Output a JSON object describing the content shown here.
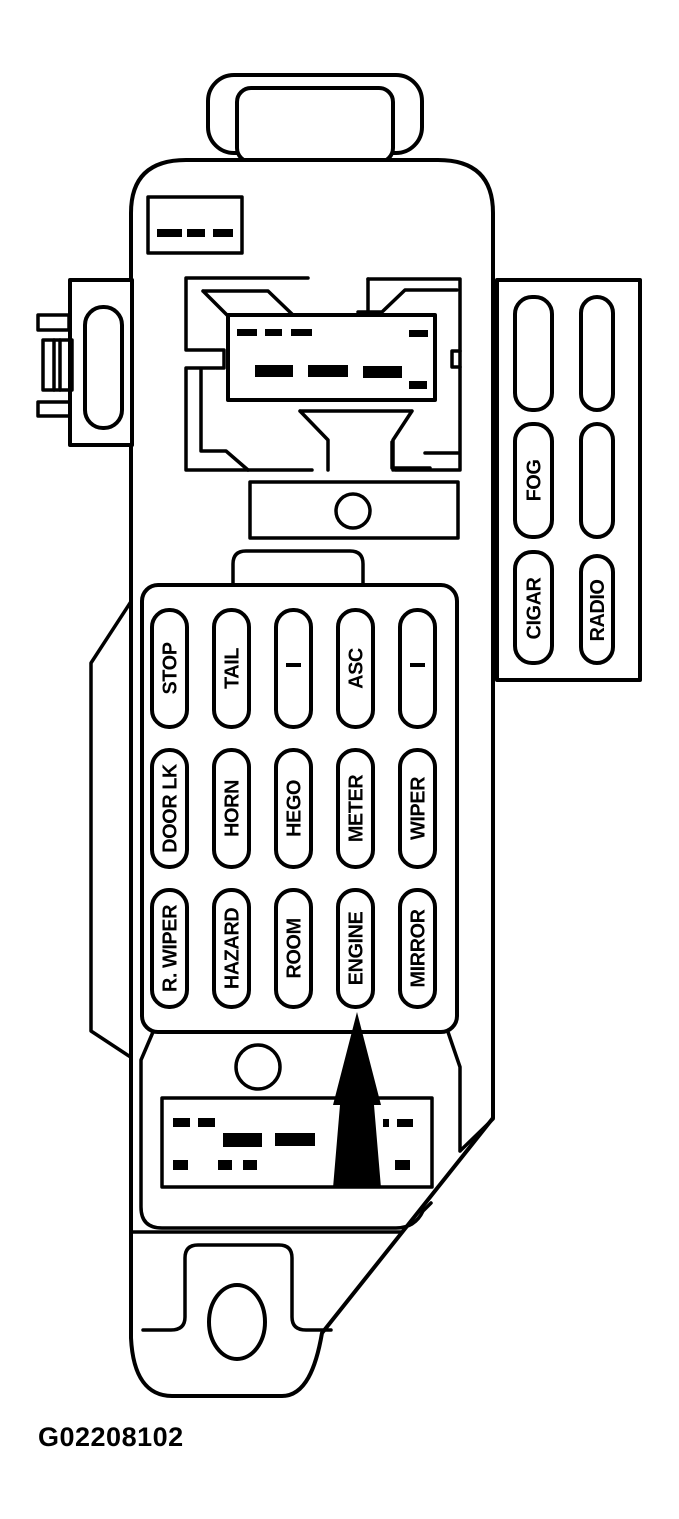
{
  "colors": {
    "ink": "#000000",
    "paper": "#ffffff"
  },
  "caption": "G02208102",
  "fuse_panel": {
    "rows": [
      [
        "STOP",
        "TAIL",
        "–",
        "ASC",
        "–"
      ],
      [
        "DOOR LK",
        "HORN",
        "HEGO",
        "METER",
        "WIPER"
      ],
      [
        "R. WIPER",
        "HAZARD",
        "ROOM",
        "ENGINE",
        "MIRROR"
      ]
    ]
  },
  "accessory_panel": {
    "fog": "FOG",
    "cigar": "CIGAR",
    "radio": "RADIO"
  },
  "arrow": {
    "indicates": "ENGINE"
  }
}
